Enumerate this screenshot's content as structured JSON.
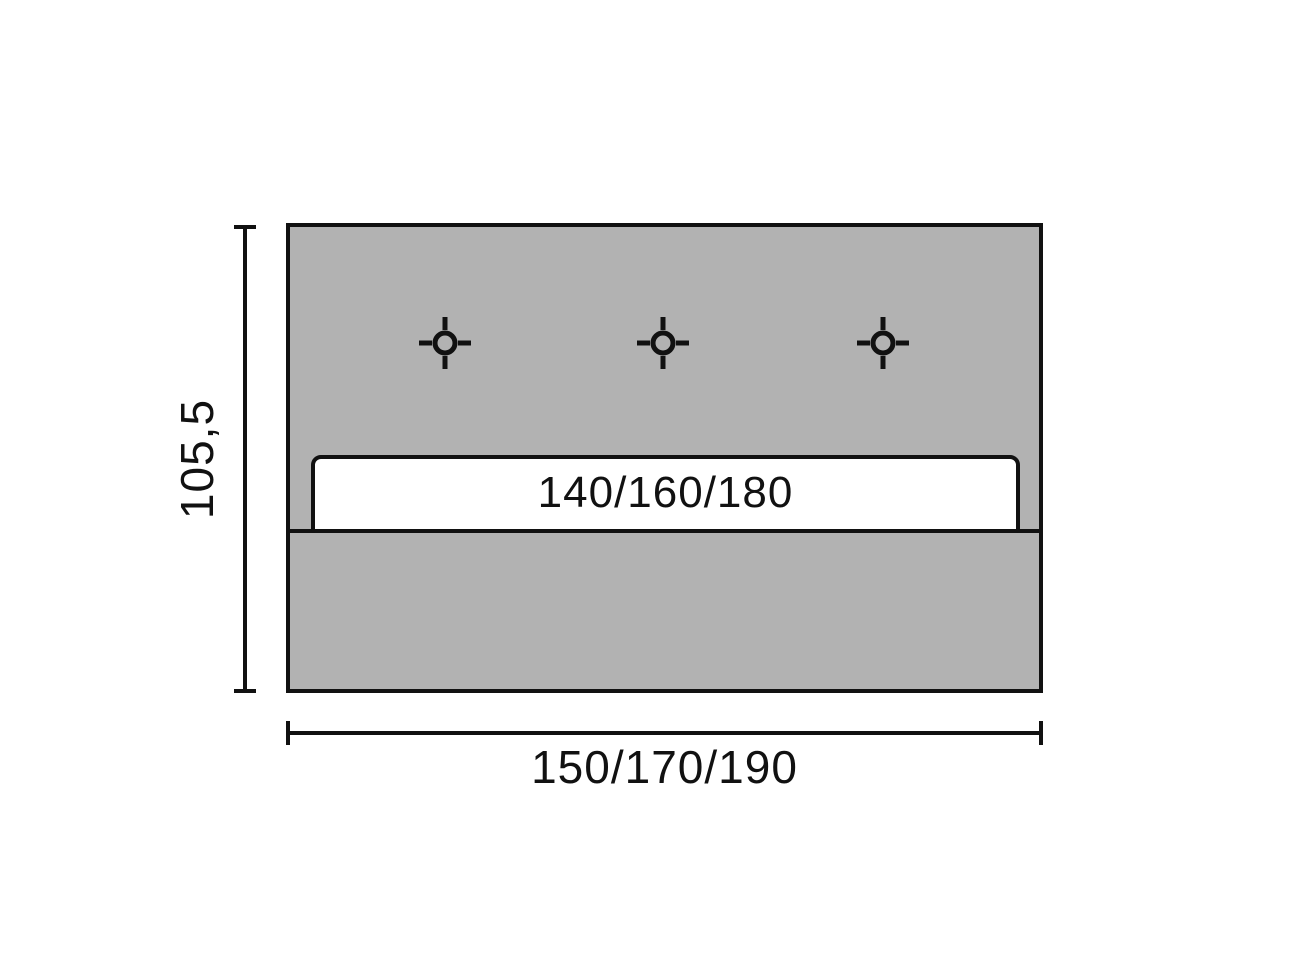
{
  "diagram": {
    "type": "technical-dimension-drawing",
    "subject": "rectangular panel (headboard) front view with mounting points and inset slat",
    "height_dimension": "105,5",
    "width_dimension": "150/170/190",
    "inner_bar_dimension": "140/160/180",
    "marker_icon": "crosshair",
    "marker_count": 3,
    "colors": {
      "panel_fill": "#b2b2b2",
      "line": "#111111",
      "background": "#ffffff",
      "slat_fill": "#ffffff"
    }
  }
}
